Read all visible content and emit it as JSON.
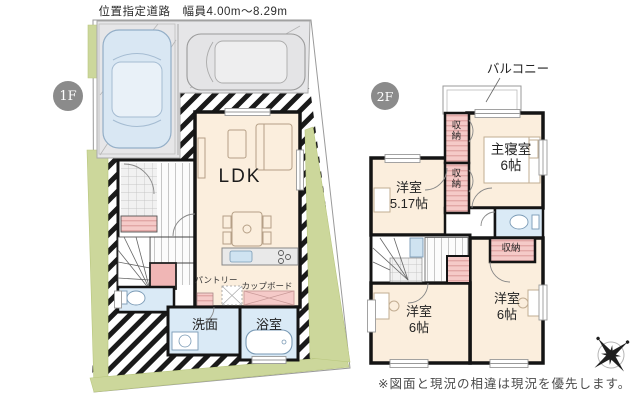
{
  "road_label": "位置指定道路　幅員4.00m〜8.29m",
  "floor1": {
    "badge": "1F",
    "rooms": {
      "ldk": "LDK",
      "pantry": "パントリー",
      "cupboard": "カップボード",
      "washroom": "洗面",
      "bathroom": "浴室"
    }
  },
  "floor2": {
    "badge": "2F",
    "balcony": "バルコニー",
    "rooms": {
      "closet_top": "収納",
      "closet_mid": "収納",
      "closet_side": "収納",
      "master_name": "主寝室",
      "master_size": "6帖",
      "room517_name": "洋室",
      "room517_size": "5.17帖",
      "room6a_name": "洋室",
      "room6a_size": "6帖",
      "room6b_name": "洋室",
      "room6b_size": "6帖"
    }
  },
  "footer": {
    "disclaimer": "※図面と現況の相違は現況を優先します。"
  },
  "icons": {
    "compass": "compass-rose-icon"
  },
  "colors": {
    "room_cream": "#fbeedd",
    "closet_pink": "#f5cac8",
    "wet_area_blue": "#daeaf6",
    "site_green": "#ccd79b",
    "parking_gray": "#e6e6e8",
    "badge_gray": "#8b8b8b",
    "wall_black": "#141414"
  }
}
